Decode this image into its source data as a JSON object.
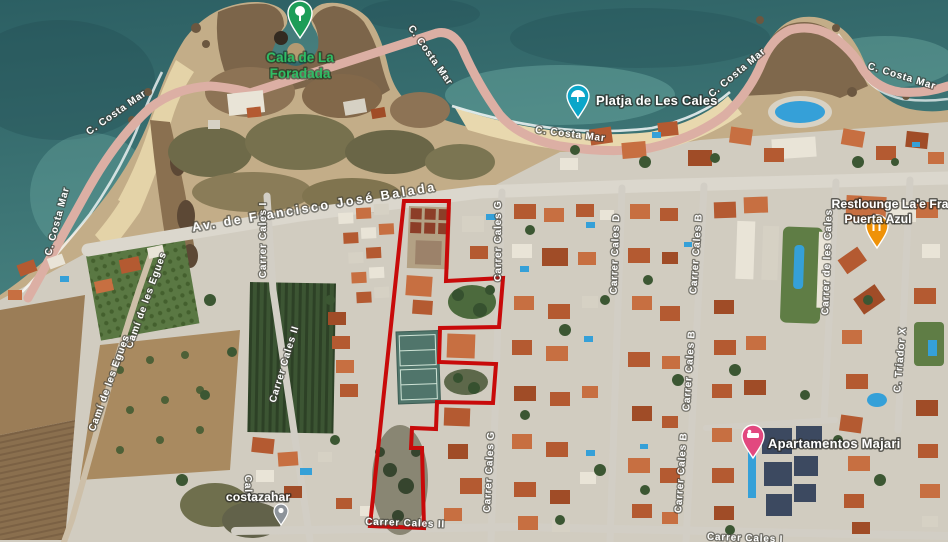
{
  "map_type": "satellite",
  "pois": {
    "cala_de_la_foradada": {
      "line1": "Cala de La",
      "line2": "Foradada"
    },
    "platja_de_les_cales": {
      "label": "Platja de Les Cales"
    },
    "restlounge": {
      "line1": "Restlounge La'e Fra",
      "line2": "Puerta Azul"
    },
    "apartamentos_majari": {
      "label": "Apartamentos Majari"
    },
    "costazahar": {
      "label": "costazahar"
    }
  },
  "streets": {
    "costa_mar": "C. Costa Mar",
    "av_balada": "Av. de Francisco José Balada",
    "cami_egues": "Camí de les Egues",
    "cales_i": "Carrer Cales I",
    "cales_ii": "Carrer Cales II",
    "cales_g": "Carrer Cales G",
    "cales_d": "Carrer Cales D",
    "cales_b": "Carrer Cales B",
    "de_les_cales": "Carrer de les Cales",
    "triador_x": "C. Triador X",
    "cale_partial": "Cale"
  },
  "overlay": {
    "boundary_color": "#c80a0a"
  },
  "marker_colors": {
    "park_pin": "#1d9d58",
    "beach_pin": "#0ba6c9",
    "restaurant_pin": "#ef9208",
    "lodging_pin": "#e2487f",
    "generic_pin": "#8d939a"
  }
}
